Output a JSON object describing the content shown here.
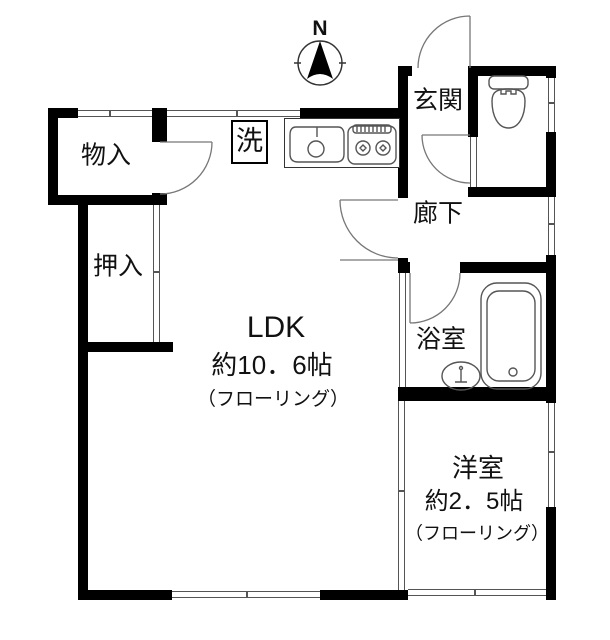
{
  "compass": {
    "label": "N"
  },
  "rooms": {
    "ldk": {
      "name": "LDK",
      "size": "約10．6帖",
      "floor": "（フローリング）"
    },
    "western_room": {
      "name": "洋室",
      "size": "約2．5帖",
      "floor": "（フローリング）"
    },
    "entrance": {
      "name": "玄関"
    },
    "hallway": {
      "name": "廊下"
    },
    "bathroom": {
      "name": "浴室"
    },
    "storage": {
      "name": "物入"
    },
    "closet": {
      "name": "押入"
    },
    "laundry": {
      "name": "洗"
    }
  },
  "colors": {
    "wall": "#000000",
    "thin_line": "#555555",
    "background": "#ffffff",
    "text": "#111111"
  }
}
